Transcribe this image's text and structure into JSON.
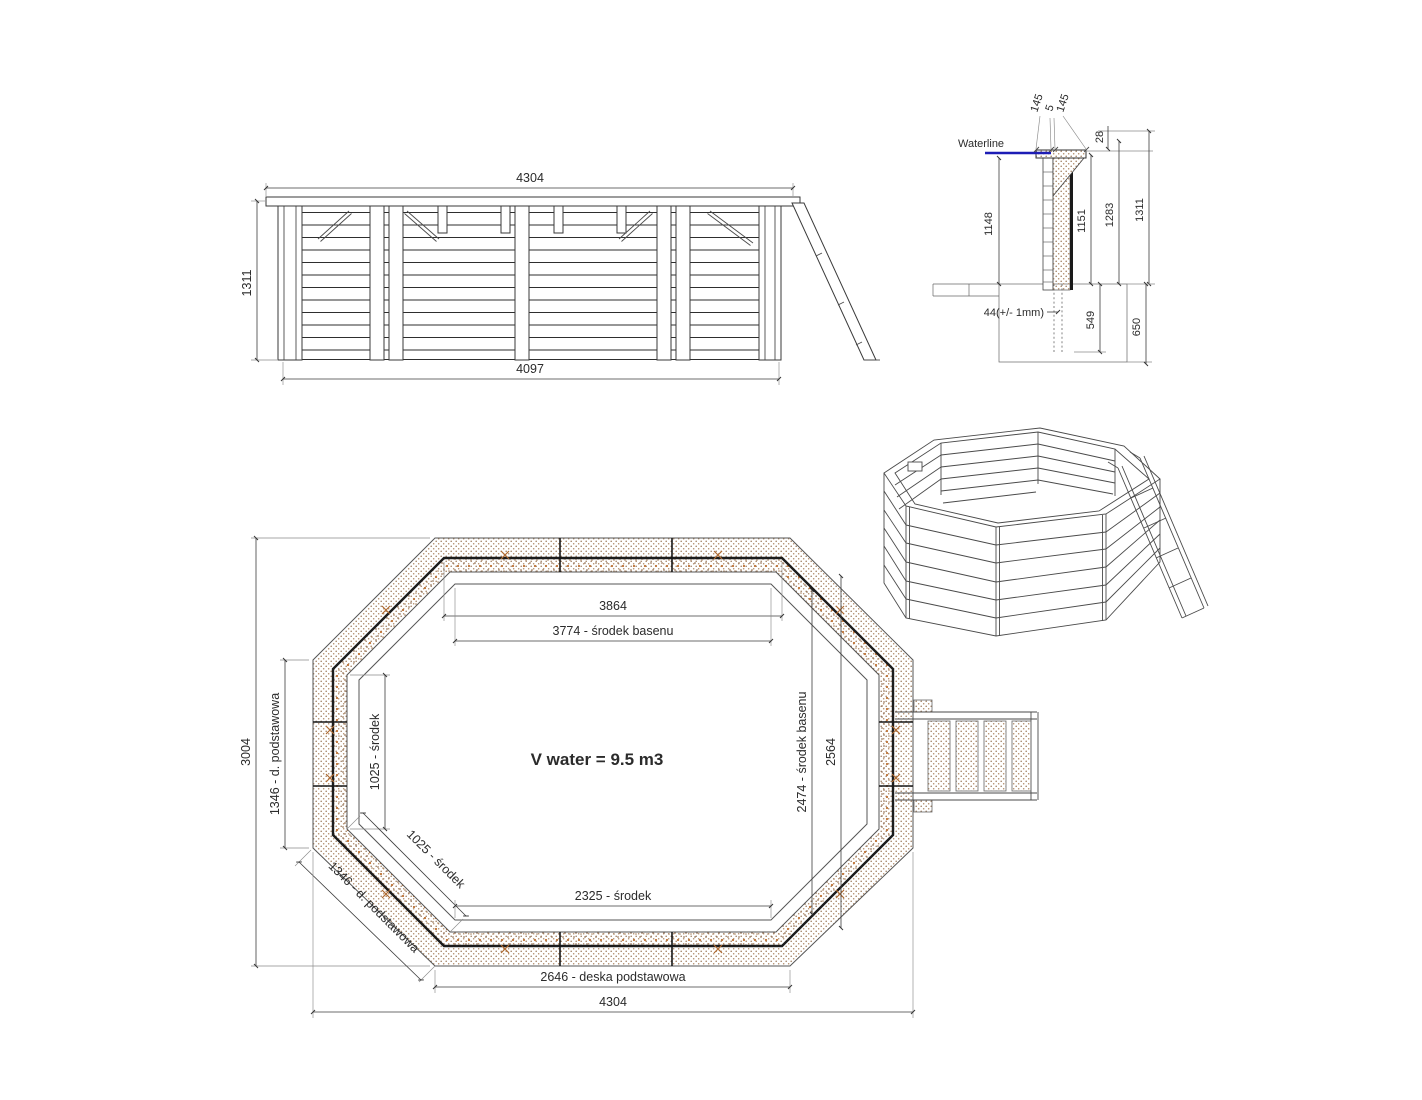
{
  "side_view": {
    "dim_top_width": "4304",
    "dim_height": "1311",
    "dim_bottom_width": "4097"
  },
  "section_view": {
    "waterline_label": "Waterline",
    "dim_cap_left": "145",
    "dim_cap_gap": "5",
    "dim_cap_right": "145",
    "dim_cap_overhang": "28",
    "dim_water_depth": "1148",
    "dim_inner_height": "1151",
    "dim_upper_height": "1283",
    "dim_total_height": "1311",
    "dim_board_note": "44(+/- 1mm)",
    "dim_embed_depth": "549",
    "dim_foundation_depth": "650"
  },
  "plan_view": {
    "volume_label": "V water = 9.5 m3",
    "dim_inner_width": "3864",
    "dim_center_width": "3774 - środek basenu",
    "dim_overall_height": "3004",
    "dim_left_board": "1346 - d. podstawowa",
    "dim_diag_board": "1346 - d. podstawowa",
    "dim_left_center": "1025 - środek",
    "dim_diag_center": "1025 - środek",
    "dim_bottom_center": "2325 - środek",
    "dim_base_board": "2646 - deska podstawowa",
    "dim_overall_width": "4304",
    "dim_right_outer": "2564",
    "dim_right_center": "2474 - środek basenu"
  },
  "colors": {
    "waterline_blue": "#1d1db5",
    "wood_dot_brown": "#9c7a5c",
    "wood_dot_orange": "#c0763a",
    "line_dark": "#1a1a1a",
    "dim_line_gray": "#3c3c3c"
  }
}
